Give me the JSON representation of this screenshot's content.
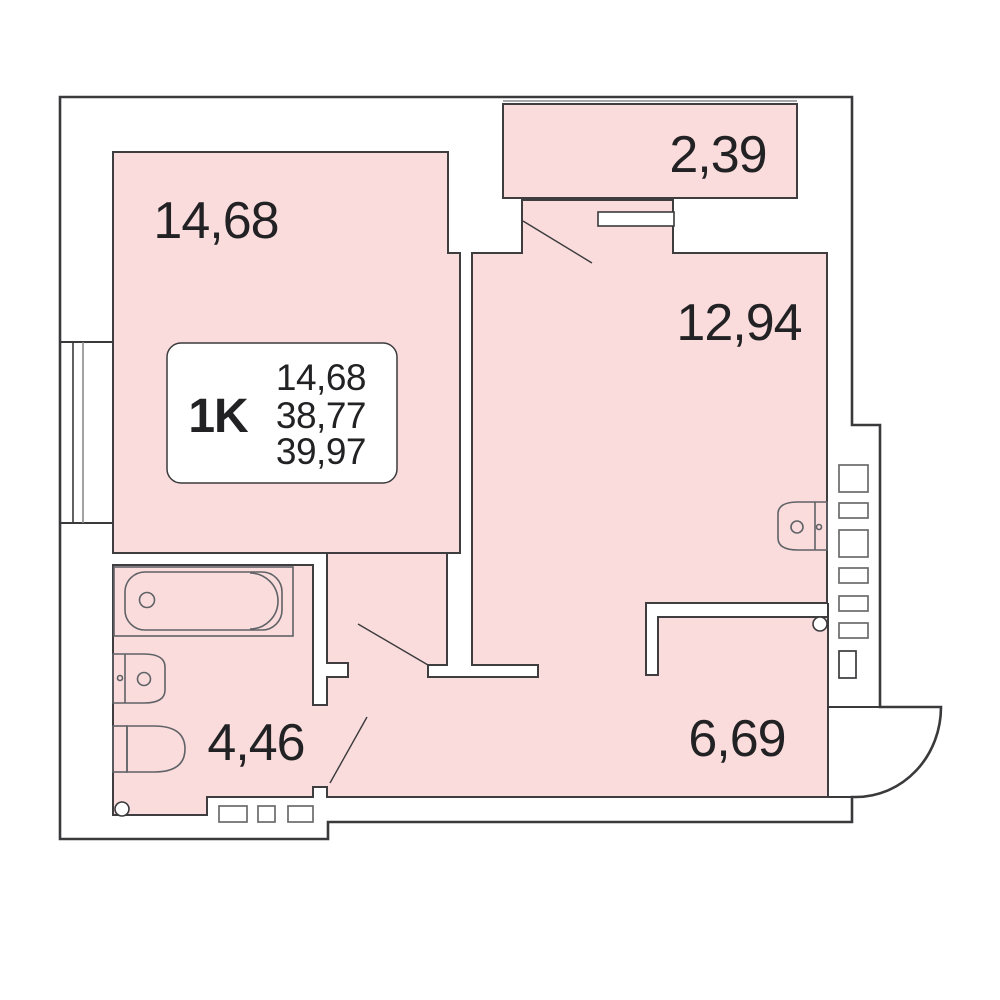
{
  "plan": {
    "title": "1K apartment floor plan",
    "rooms": [
      {
        "id": "living-room",
        "area_label": "14,68"
      },
      {
        "id": "balcony",
        "area_label": "2,39"
      },
      {
        "id": "kitchen-living",
        "area_label": "12,94"
      },
      {
        "id": "bathroom",
        "area_label": "4,46"
      },
      {
        "id": "kitchen",
        "area_label": "6,69"
      }
    ],
    "info_card": {
      "type_label": "1K",
      "living_area": "14,68",
      "floor_area": "38,77",
      "total_area": "39,97"
    },
    "icons": [
      "bathtub-icon",
      "washbasin-icon",
      "toilet-icon",
      "kitchen-sink-icon",
      "pipe-riser-icon",
      "vent-shaft-icon",
      "door-swing-icon",
      "window-icon"
    ],
    "colors": {
      "floor_fill": "#fadcdc",
      "wall_line": "#3a3a3c",
      "fixture_line": "#5f6266",
      "shaft_line": "#6b6b6b",
      "glazing_line": "#8a8a8a",
      "text": "#222224",
      "background": "#ffffff"
    }
  }
}
